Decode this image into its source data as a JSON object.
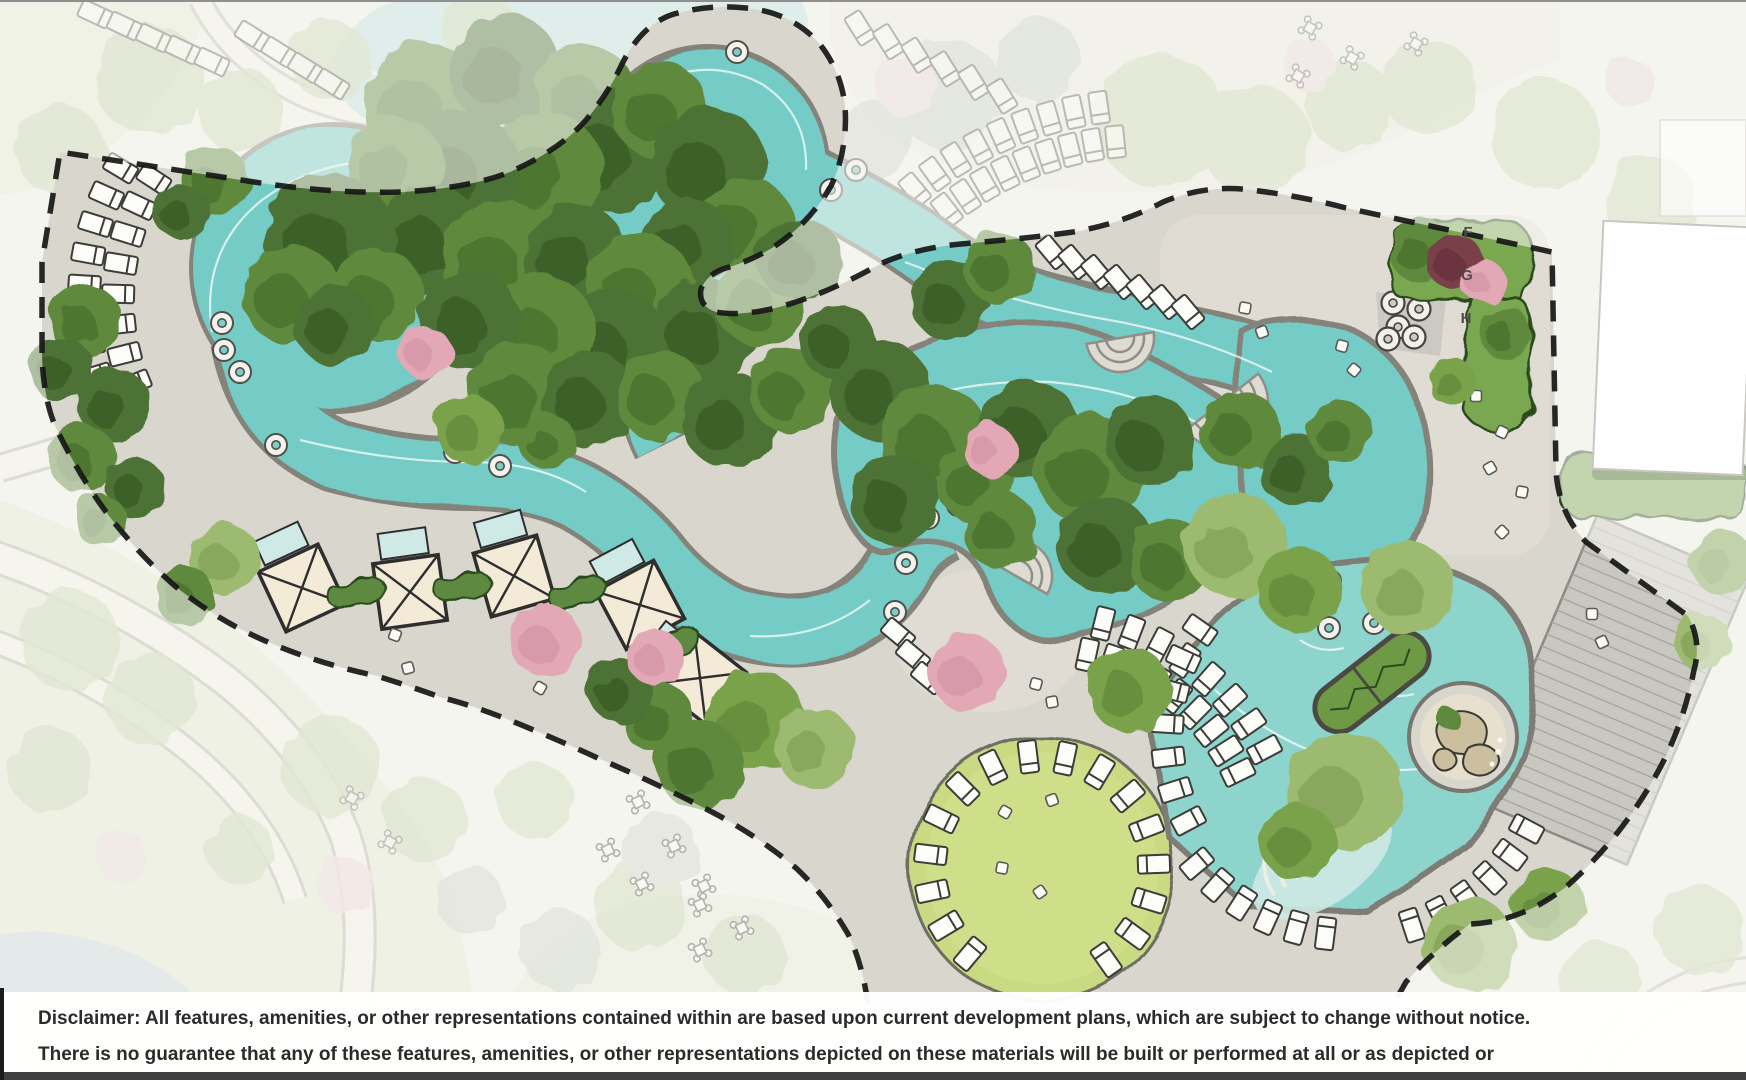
{
  "plan": {
    "type": "resort-amenity-site-plan",
    "markers": [
      {
        "label": "F"
      },
      {
        "label": "G"
      },
      {
        "label": "H"
      }
    ],
    "colors": {
      "river_water": "#74cbc5",
      "pool_water": "#8dd4cd",
      "faded_water": "#c2e4e1",
      "canopy_dark": "#4e7234",
      "canopy_mid": "#5f8a3e",
      "canopy_light": "#7aa24c",
      "canopy_sage": "#9cbb70",
      "canopy_faded": "#c6d4ae",
      "flower_pink": "#e3a8b6",
      "flower_maroon": "#7a4049",
      "deck": "#d9d6ce",
      "deck_light": "#e0ddd5",
      "paver": "#c9c7c1",
      "lawn_event": "#c9da83",
      "lawn_faded": "#e2e9d0",
      "pond_faded": "#c8dadd",
      "hedge": "#79a851",
      "cabana_fill": "#f3ead8",
      "cabana_pool": "#cfe9e7",
      "boundary": "#161616",
      "chair_fill": "#fcfcf9",
      "chair_stroke": "#3c3c38",
      "footer_bar": "#3f3f3f",
      "text": "#2b2b2b"
    }
  },
  "footer": {
    "disclaimer": "Disclaimer: All features, amenities, or other representations contained within are based upon current development plans, which are subject to change without notice. There is no guarantee that any of these features, amenities, or other representations depicted on these materials will be built or performed at all or as depicted or described. © 2023 Tellus Group LLC"
  }
}
